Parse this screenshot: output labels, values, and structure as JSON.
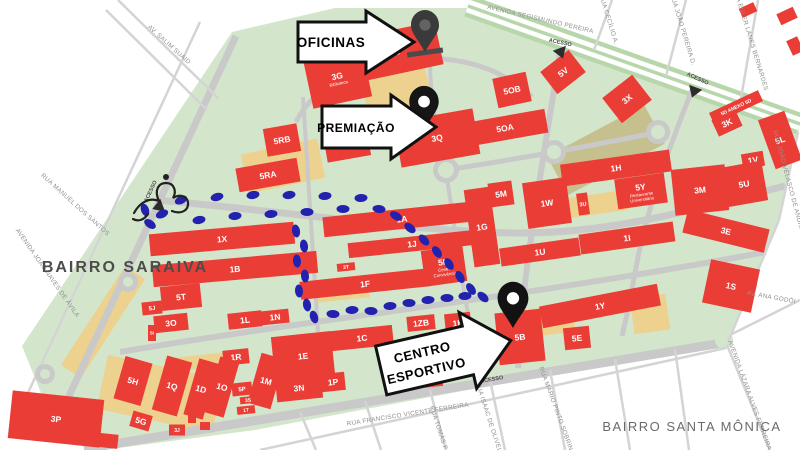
{
  "colors": {
    "campus": "#d3e6cb",
    "road": "#c9c9c9",
    "road_light": "#d4d4d4",
    "avenue_green": "#b7d7ab",
    "building": "#e93d36",
    "building_text": "#ffffff",
    "trail": "#2222af",
    "street_text": "#8f8f8f",
    "parking": "#ecd28e",
    "field": "#c6c08f",
    "access_text": "#4a4a4a",
    "access_triangle": "#2d2d2d",
    "callout_bg": "#ffffff",
    "callout_border": "#111111",
    "area_saraiva_color": "#4c4c4c",
    "area_santa_color": "#6a6a6a",
    "pin_dark": "#3a3a3a",
    "pin_black": "#141414"
  },
  "areas": [
    {
      "name": "BAIRRO SARAIVA",
      "x": 125,
      "y": 272,
      "fs": 16,
      "ls": 2,
      "bold": true,
      "color": "#4c4c4c"
    },
    {
      "name": "BAIRRO SANTA MÔNICA",
      "x": 692,
      "y": 431,
      "fs": 13,
      "ls": 1.5,
      "bold": false,
      "color": "#6a6a6a"
    }
  ],
  "callouts": [
    {
      "id": "oficinas",
      "lines": [
        "OFICINAS"
      ],
      "poly": "298,22 366,22 366,11 414,42 366,73 366,62 298,62",
      "tx": 331,
      "ty": 47,
      "fs": 13.5
    },
    {
      "id": "premiacao",
      "lines": [
        "PREMIAÇÃO"
      ],
      "poly": "322,106 391,106 391,95 436,127 391,159 391,148 322,148",
      "tx": 356,
      "ty": 132,
      "fs": 12
    },
    {
      "id": "centro-esportivo",
      "lines": [
        "CENTRO",
        "ESPORTIVO"
      ],
      "poly": "380,331 469,331 469,317 513,356 469,395 469,381 380,381",
      "rot": "-13 444 358",
      "tx": 424,
      "ty": 352,
      "lh": 19,
      "fs": 13
    }
  ],
  "pins": [
    {
      "id": "pin-oficinas",
      "x": 425,
      "tip": 52,
      "s": 1.0,
      "color": "#3a3a3a",
      "hole": "#636363",
      "shadow": true
    },
    {
      "id": "pin-premiacao",
      "x": 424,
      "tip": 130,
      "s": 1.05,
      "color": "#161616",
      "hole": "#ffffff"
    },
    {
      "id": "pin-centro-esportivo",
      "x": 513,
      "tip": 328,
      "s": 1.1,
      "color": "#121212",
      "hole": "#ffffff"
    }
  ],
  "access": [
    {
      "label": "ACESSO",
      "x": 152,
      "y": 192,
      "rot": -65,
      "tx": 158,
      "ty": 207,
      "trot": -110
    },
    {
      "label": "ACESSO",
      "x": 560,
      "y": 44,
      "rot": 12,
      "tx": 561,
      "ty": 53,
      "trot": 160
    },
    {
      "label": "ACESSO",
      "x": 697,
      "y": 80,
      "rot": 25,
      "tx": 694,
      "ty": 92,
      "trot": 200
    },
    {
      "label": "ACESSO",
      "x": 492,
      "y": 381,
      "rot": -10,
      "tx": 478,
      "ty": 373,
      "trot": -60
    }
  ],
  "streets": [
    {
      "name": "AVENIDA SEGISMUNDO PEREIRA",
      "x": 540,
      "y": 21,
      "rot": 13
    },
    {
      "name": "AV. SALIM SUAID",
      "x": 168,
      "y": 46,
      "rot": 42
    },
    {
      "name": "RUA MANUEL DOS SANTOS",
      "x": 74,
      "y": 206,
      "rot": 42
    },
    {
      "name": "AVENIDA JOÃO NAVES DE ÁVILA",
      "x": 46,
      "y": 274,
      "rot": 55
    },
    {
      "name": "RUA CECÍLIO A.",
      "x": 607,
      "y": 20,
      "rot": 73
    },
    {
      "name": "RUA JOÃO PEREIRA D.",
      "x": 681,
      "y": 30,
      "rot": 73
    },
    {
      "name": "RUA EULER LANES BERNARDES",
      "x": 749,
      "y": 40,
      "rot": 73
    },
    {
      "name": "RUA JOÃO VELASCO DE ANDRADE",
      "x": 788,
      "y": 186,
      "rot": 75
    },
    {
      "name": "AV. ANA GODÓI",
      "x": 771,
      "y": 299,
      "rot": 10
    },
    {
      "name": "AVENIDA LÁZARA ALVES FERREIRA",
      "x": 748,
      "y": 396,
      "rot": 70
    },
    {
      "name": "RUA MÁRIO PINTO SOBRINHO",
      "x": 556,
      "y": 414,
      "rot": 70
    },
    {
      "name": "RUA ISAAC DE OLIVEIRA",
      "x": 488,
      "y": 421,
      "rot": 72
    },
    {
      "name": "RUA TOMÁS F.",
      "x": 437,
      "y": 429,
      "rot": 72
    },
    {
      "name": "RUA FRANCISCO VICENTE FERREIRA",
      "x": 408,
      "y": 416,
      "rot": -9
    }
  ],
  "buildings": [
    {
      "label": "5S",
      "x": 395,
      "y": 52,
      "w": 90,
      "h": 44,
      "rot": -12
    },
    {
      "label": "3G",
      "sub": [
        "Biblioteca"
      ],
      "x": 338,
      "y": 80,
      "w": 60,
      "h": 46,
      "rot": -12
    },
    {
      "label": "3Q",
      "x": 437,
      "y": 138,
      "w": 80,
      "h": 46,
      "rot": -10
    },
    {
      "label": "3D",
      "x": 347,
      "y": 145,
      "w": 44,
      "h": 28,
      "rot": -10
    },
    {
      "label": "5OB",
      "x": 512,
      "y": 90,
      "w": 34,
      "h": 30,
      "rot": -12
    },
    {
      "label": "5OA",
      "x": 505,
      "y": 128,
      "w": 84,
      "h": 24,
      "rot": -10
    },
    {
      "label": "5V",
      "x": 563,
      "y": 72,
      "w": 36,
      "h": 28,
      "rot": -38
    },
    {
      "label": "3X",
      "x": 627,
      "y": 99,
      "w": 38,
      "h": 32,
      "rot": -38
    },
    {
      "label": "5D ANEXO  5D",
      "fs": 5,
      "x": 736,
      "y": 107,
      "w": 54,
      "h": 12,
      "rot": -25
    },
    {
      "label": "3K",
      "x": 727,
      "y": 123,
      "w": 26,
      "h": 18,
      "rot": -25
    },
    {
      "label": "5L",
      "x": 780,
      "y": 140,
      "w": 28,
      "h": 52,
      "rot": -20
    },
    {
      "label": "1V",
      "x": 753,
      "y": 160,
      "w": 22,
      "h": 15,
      "rot": -10
    },
    {
      "label": "5U",
      "x": 744,
      "y": 184,
      "w": 42,
      "h": 40,
      "rot": -10
    },
    {
      "label": "3M",
      "x": 700,
      "y": 190,
      "w": 54,
      "h": 46,
      "rot": -6
    },
    {
      "label": "3E",
      "x": 726,
      "y": 231,
      "w": 84,
      "h": 24,
      "rot": 14
    },
    {
      "label": "1S",
      "x": 731,
      "y": 286,
      "w": 50,
      "h": 44,
      "rot": 12
    },
    {
      "label": "1H",
      "x": 616,
      "y": 168,
      "w": 110,
      "h": 22,
      "rot": -8
    },
    {
      "label": "5Y",
      "sub": [
        "Restaurante",
        "Universitário"
      ],
      "x": 641,
      "y": 191,
      "w": 50,
      "h": 30,
      "rot": -8
    },
    {
      "label": "1W",
      "x": 547,
      "y": 203,
      "w": 44,
      "h": 46,
      "rot": -8
    },
    {
      "label": "5M",
      "x": 501,
      "y": 194,
      "w": 24,
      "h": 24,
      "rot": -8
    },
    {
      "label": "3U",
      "fs": 5.5,
      "x": 583,
      "y": 204,
      "w": 11,
      "h": 22,
      "rot": -8
    },
    {
      "label": "1G",
      "x": 482,
      "y": 227,
      "w": 26,
      "h": 78,
      "rot": -8
    },
    {
      "label": "1U",
      "x": 540,
      "y": 252,
      "w": 80,
      "h": 18,
      "rot": -8
    },
    {
      "label": "1I",
      "x": 627,
      "y": 238,
      "w": 95,
      "h": 20,
      "rot": -8
    },
    {
      "label": "1A",
      "x": 402,
      "y": 219,
      "w": 158,
      "h": 20,
      "rot": -6
    },
    {
      "label": "1J",
      "x": 412,
      "y": 244,
      "w": 128,
      "h": 15,
      "rot": -6
    },
    {
      "label": "1X",
      "x": 222,
      "y": 239,
      "w": 145,
      "h": 22,
      "rot": -5
    },
    {
      "label": "1B",
      "x": 235,
      "y": 269,
      "w": 165,
      "h": 22,
      "rot": -5
    },
    {
      "label": "1F",
      "x": 365,
      "y": 284,
      "w": 130,
      "h": 18,
      "rot": -6
    },
    {
      "label": "3T",
      "fs": 5,
      "x": 346,
      "y": 267,
      "w": 18,
      "h": 8,
      "rot": -6
    },
    {
      "label": "5N",
      "sub": [
        "Centro",
        "Convivência"
      ],
      "x": 444,
      "y": 266,
      "w": 42,
      "h": 36,
      "rot": -8
    },
    {
      "label": "5RB",
      "x": 282,
      "y": 140,
      "w": 34,
      "h": 28,
      "rot": -10
    },
    {
      "label": "5RA",
      "x": 268,
      "y": 175,
      "w": 62,
      "h": 24,
      "rot": -10
    },
    {
      "label": "5T",
      "x": 181,
      "y": 297,
      "w": 40,
      "h": 24,
      "rot": -6
    },
    {
      "label": "5J",
      "x": 152,
      "y": 308,
      "w": 20,
      "h": 13,
      "rot": -6
    },
    {
      "label": "3O",
      "x": 171,
      "y": 323,
      "w": 34,
      "h": 17,
      "rot": -6
    },
    {
      "label": "5I",
      "fs": 4.5,
      "x": 152,
      "y": 333,
      "w": 8,
      "h": 16,
      "rot": 0
    },
    {
      "label": "1L",
      "x": 245,
      "y": 320,
      "w": 34,
      "h": 16,
      "rot": -6
    },
    {
      "label": "1N",
      "x": 275,
      "y": 317,
      "w": 28,
      "h": 14,
      "rot": -6
    },
    {
      "label": "1C",
      "x": 362,
      "y": 338,
      "w": 62,
      "h": 20,
      "rot": -6
    },
    {
      "label": "1ZB",
      "x": 421,
      "y": 323,
      "w": 28,
      "h": 15,
      "rot": -6
    },
    {
      "label": "1K",
      "x": 458,
      "y": 323,
      "w": 26,
      "h": 20,
      "rot": -6
    },
    {
      "label": "5K",
      "x": 421,
      "y": 367,
      "w": 40,
      "h": 42,
      "rot": -6
    },
    {
      "label": "1E",
      "x": 303,
      "y": 356,
      "w": 60,
      "h": 44,
      "rot": -6
    },
    {
      "label": "1R",
      "x": 236,
      "y": 357,
      "w": 26,
      "h": 15,
      "rot": -6
    },
    {
      "label": "5H",
      "x": 133,
      "y": 381,
      "w": 28,
      "h": 44,
      "rot": 16
    },
    {
      "label": "1Q",
      "x": 172,
      "y": 386,
      "w": 26,
      "h": 56,
      "rot": 16
    },
    {
      "label": "1D",
      "x": 201,
      "y": 389,
      "w": 20,
      "h": 58,
      "rot": 16
    },
    {
      "label": "1O",
      "x": 222,
      "y": 387,
      "w": 20,
      "h": 58,
      "rot": 16
    },
    {
      "label": "1M",
      "x": 266,
      "y": 381,
      "w": 24,
      "h": 52,
      "rot": 16
    },
    {
      "label": "5P",
      "x": 242,
      "y": 389,
      "w": 20,
      "h": 13,
      "rot": -6
    },
    {
      "label": "3S",
      "fs": 5,
      "x": 248,
      "y": 400,
      "w": 16,
      "h": 7,
      "rot": -6
    },
    {
      "label": "1T",
      "fs": 5,
      "x": 246,
      "y": 410,
      "w": 18,
      "h": 8,
      "rot": -6
    },
    {
      "label": "3N",
      "x": 299,
      "y": 388,
      "w": 46,
      "h": 24,
      "rot": -6
    },
    {
      "label": "1P",
      "x": 333,
      "y": 382,
      "w": 24,
      "h": 18,
      "rot": -6
    },
    {
      "label": "5G",
      "x": 141,
      "y": 421,
      "w": 20,
      "h": 16,
      "rot": 16
    },
    {
      "label": "3J",
      "fs": 5,
      "x": 177,
      "y": 430,
      "w": 16,
      "h": 11,
      "rot": 0
    },
    {
      "label": "",
      "x": 192,
      "y": 419,
      "w": 8,
      "h": 8,
      "rot": 0
    },
    {
      "label": "",
      "x": 205,
      "y": 426,
      "w": 10,
      "h": 8,
      "rot": 0
    },
    {
      "label": "3P",
      "x": 56,
      "y": 419,
      "w": 92,
      "h": 48,
      "rot": 6
    },
    {
      "label": "",
      "x": 100,
      "y": 440,
      "w": 36,
      "h": 14,
      "rot": 6
    },
    {
      "label": "5B",
      "x": 520,
      "y": 337,
      "w": 46,
      "h": 52,
      "rot": -6
    },
    {
      "label": "5E",
      "x": 577,
      "y": 338,
      "w": 26,
      "h": 22,
      "rot": -6
    },
    {
      "label": "1Y",
      "x": 600,
      "y": 306,
      "w": 120,
      "h": 22,
      "rot": -11
    },
    {
      "label": "",
      "x": 748,
      "y": 10,
      "w": 16,
      "h": 10,
      "rot": -25
    },
    {
      "label": "",
      "x": 787,
      "y": 16,
      "w": 18,
      "h": 12,
      "rot": -25
    },
    {
      "label": "",
      "x": 795,
      "y": 46,
      "w": 12,
      "h": 16,
      "rot": -25
    }
  ],
  "footprints": [
    [
      150,
      224,
      35
    ],
    [
      145,
      210,
      70
    ],
    [
      162,
      214,
      -25
    ],
    [
      181,
      200,
      -25
    ],
    [
      199,
      220,
      -10
    ],
    [
      217,
      197,
      -15
    ],
    [
      235,
      216,
      -5
    ],
    [
      253,
      195,
      -10
    ],
    [
      271,
      214,
      -5
    ],
    [
      289,
      195,
      -8
    ],
    [
      307,
      212,
      0
    ],
    [
      325,
      196,
      -5
    ],
    [
      343,
      209,
      0
    ],
    [
      361,
      198,
      -3
    ],
    [
      379,
      209,
      5
    ],
    [
      396,
      216,
      30
    ],
    [
      410,
      228,
      40
    ],
    [
      424,
      240,
      48
    ],
    [
      437,
      252,
      55
    ],
    [
      449,
      264,
      58
    ],
    [
      460,
      277,
      60
    ],
    [
      471,
      289,
      55
    ],
    [
      483,
      297,
      42
    ],
    [
      296,
      231,
      80
    ],
    [
      304,
      246,
      82
    ],
    [
      297,
      261,
      85
    ],
    [
      305,
      276,
      85
    ],
    [
      299,
      291,
      85
    ],
    [
      307,
      305,
      80
    ],
    [
      314,
      317,
      72
    ],
    [
      333,
      314,
      3
    ],
    [
      352,
      310,
      -4
    ],
    [
      371,
      311,
      3
    ],
    [
      390,
      306,
      -4
    ],
    [
      409,
      303,
      0
    ],
    [
      428,
      300,
      -4
    ],
    [
      447,
      298,
      0
    ],
    [
      465,
      296,
      -3
    ]
  ],
  "map_shapes": {
    "campus_outline": "22,346 232,32 335,8 468,8 800,124 798,132 779,220 728,342 520,380 255,430 118,448 52,420",
    "roads": [
      {
        "d": "M468,6 L800,124",
        "w": 22,
        "c": "#b7d7ab"
      },
      {
        "d": "M468,6 L800,124",
        "w": 13,
        "c": "#ffffff"
      },
      {
        "d": "M468,6 L800,124",
        "w": 3.5,
        "c": "#b7d7ab"
      },
      {
        "d": "M56,424 L236,36",
        "w": 7,
        "c": "#c9c9c9"
      },
      {
        "d": "M84,449 L728,342",
        "w": 9,
        "c": "#c9c9c9"
      },
      {
        "d": "M157,200 C300,213 430,233 520,233 C620,233 700,207 785,186",
        "w": 7,
        "c": "#c9c9c9"
      },
      {
        "d": "M120,352 C320,318 520,298 766,252",
        "w": 6,
        "c": "#c9c9c9"
      },
      {
        "d": "M303,97 L318,332",
        "w": 4,
        "c": "#c9c9c9"
      },
      {
        "d": "M560,52 C548,130 532,220 523,300 L518,368",
        "w": 6,
        "c": "#c9c9c9"
      },
      {
        "d": "M692,90 C672,140 648,205 637,262 C630,300 626,320 622,336",
        "w": 5,
        "c": "#c9c9c9"
      },
      {
        "d": "M296,122 C318,78 378,56 430,58 C482,60 512,78 532,97",
        "w": 5,
        "c": "#c9c9c9"
      },
      {
        "d": "M430,60 C430,100 438,140 446,168",
        "w": 4,
        "c": "#c9c9c9"
      },
      {
        "d": "M446,170 C480,165 520,158 554,152 C600,144 630,138 658,132",
        "w": 5,
        "c": "#c9c9c9"
      },
      {
        "d": "M446,172 C452,210 458,250 463,285 C468,315 472,335 475,352",
        "w": 4,
        "c": "#c9c9c9"
      },
      {
        "d": "M118,0 L219,99",
        "w": 2.5,
        "c": "#d4d4d4"
      },
      {
        "d": "M106,10 L207,110",
        "w": 2.5,
        "c": "#d4d4d4"
      },
      {
        "d": "M20,410 L200,22",
        "w": 2.5,
        "c": "#d4d4d4"
      }
    ],
    "neighborhood_lines": [
      [
        612,
        0,
        594,
        50
      ],
      [
        686,
        0,
        666,
        76
      ],
      [
        758,
        0,
        740,
        104
      ],
      [
        798,
        132,
        779,
        220
      ],
      [
        779,
        220,
        728,
        342
      ],
      [
        732,
        334,
        800,
        300
      ],
      [
        727,
        345,
        770,
        450
      ],
      [
        260,
        450,
        726,
        348
      ],
      [
        300,
        412,
        316,
        450
      ],
      [
        365,
        401,
        381,
        450
      ],
      [
        430,
        390,
        446,
        450
      ],
      [
        490,
        380,
        505,
        450
      ],
      [
        550,
        370,
        565,
        450
      ],
      [
        615,
        359,
        630,
        450
      ],
      [
        675,
        349,
        689,
        450
      ]
    ],
    "roundabouts": [
      [
        446,
        170,
        13,
        0
      ],
      [
        554,
        152,
        12,
        0
      ],
      [
        658,
        132,
        12,
        0
      ],
      [
        128,
        282,
        10,
        0
      ],
      [
        45,
        374,
        10,
        0
      ],
      [
        724,
        340,
        9,
        1
      ]
    ],
    "parking": [
      [
        398,
        96,
        66,
        72,
        -14,
        0
      ],
      [
        283,
        166,
        78,
        40,
        -12,
        0
      ],
      [
        606,
        150,
        110,
        44,
        -28,
        1
      ],
      [
        597,
        204,
        62,
        20,
        -8,
        0
      ],
      [
        342,
        291,
        54,
        18,
        -6,
        0
      ],
      [
        160,
        394,
        118,
        55,
        12,
        0
      ],
      [
        103,
        322,
        118,
        24,
        -57,
        0
      ],
      [
        547,
        321,
        54,
        28,
        -8,
        0
      ],
      [
        650,
        314,
        36,
        36,
        -8,
        0
      ],
      [
        433,
        346,
        26,
        15,
        -6,
        0
      ],
      [
        200,
        362,
        70,
        14,
        -6,
        0
      ]
    ],
    "start_icon": "M134,213 C140,202 150,197 159,201 C154,191 158,183 166,183 C174,183 177,191 173,198 C181,193 189,197 188,205 C187,212 179,214 172,211 M148,214 C144,220 138,222 133,219",
    "pin_path": "M0,0 C-8,-14 -14,-19 -14,-27 C-14,-36 -7,-42 0,-42 C7,-42 14,-36 14,-27 C14,-19 8,-14 0,0 Z"
  }
}
